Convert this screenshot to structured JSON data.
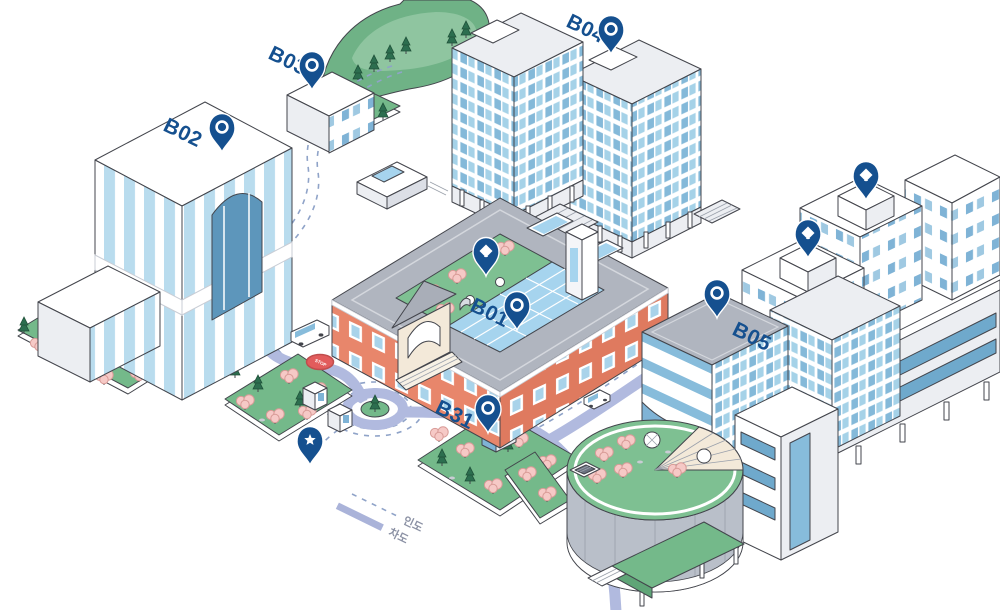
{
  "map": {
    "type": "isometric-campus-map",
    "background": "#ffffff"
  },
  "buildings": {
    "b01": {
      "label": "B01",
      "pin_icon": "ring"
    },
    "b02": {
      "label": "B02",
      "pin_icon": "ring"
    },
    "b03": {
      "label": "B03",
      "pin_icon": "ring"
    },
    "b04": {
      "label": "B04",
      "pin_icon": "ring"
    },
    "b05": {
      "label": "B05",
      "pin_icon": "ring"
    },
    "b31": {
      "label": "B31",
      "pin_icon": "ring"
    }
  },
  "markers": {
    "diamond_pins": [
      {
        "icon": "diamond",
        "location": "b01-courtyard-roof"
      },
      {
        "icon": "diamond",
        "location": "northeast-tower-upper"
      },
      {
        "icon": "diamond",
        "location": "northeast-tower-lower"
      }
    ],
    "star_pin": {
      "icon": "star",
      "location": "plaza-kiosks"
    },
    "bus_stop": {
      "label": "STOP"
    }
  },
  "legend": {
    "sidewalk": {
      "label": "인도",
      "style": "dashed"
    },
    "road": {
      "label": "차도",
      "style": "solid"
    }
  },
  "colors": {
    "pin_blue": "#15508f",
    "road_lavender": "#b1badf",
    "path_dash_blue": "#8fa3c8",
    "lawn_green": "#74b98a",
    "pine_green": "#2c6e4f",
    "blossom_pink": "#f6c9c6",
    "brick_salmon": "#e8866b",
    "glass_blue": "#87bcdb",
    "atrium_blue": "#a6d4ee",
    "roof_gray": "#b0b5bf",
    "stop_red": "#e25c5c",
    "legend_text": "#8b91a4"
  }
}
